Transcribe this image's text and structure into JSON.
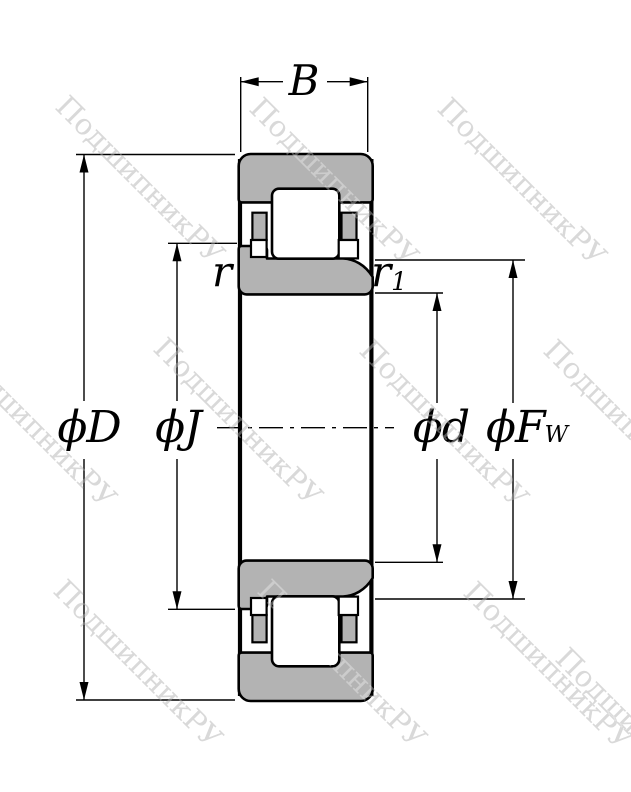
{
  "meta": {
    "description": "Technical cross-section drawing of an NJ-type cylindrical roller bearing with dimension callouts",
    "view": "bearing-cross-section"
  },
  "colors": {
    "ring_fill": "#b3b3b3",
    "roller_fill": "#ffffff",
    "outline": "#000000",
    "dimension_line": "#000000",
    "watermark": "#c7c7c7"
  },
  "labels": {
    "width": "B",
    "outer_diameter": "ϕD",
    "flange_diameter": "ϕJ",
    "bore_diameter": "ϕd",
    "raceway_diameter_base": "ϕF",
    "raceway_diameter_sub": "W",
    "chamfer": "r",
    "chamfer1_base": "r",
    "chamfer1_sub": "1"
  },
  "watermark": {
    "text": "ПодшипникРУ",
    "angle_deg": 45,
    "positions": [
      [
        54,
        108
      ],
      [
        248,
        110
      ],
      [
        436,
        110
      ],
      [
        -54,
        352
      ],
      [
        152,
        350
      ],
      [
        358,
        352
      ],
      [
        542,
        352
      ],
      [
        52,
        592
      ],
      [
        256,
        592
      ],
      [
        462,
        594
      ],
      [
        554,
        660
      ]
    ]
  }
}
